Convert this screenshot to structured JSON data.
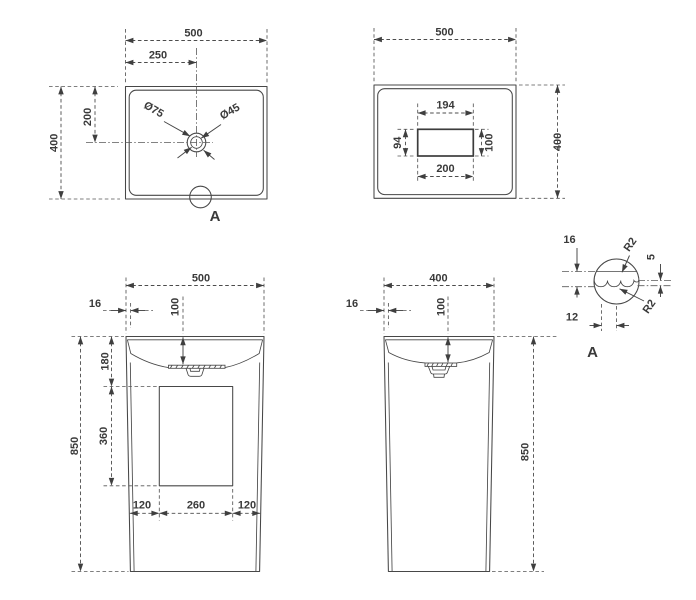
{
  "views": {
    "plan_top": {
      "overall_width": "500",
      "hole_offset_x": "250",
      "overall_depth": "400",
      "hole_offset_y": "200",
      "faucet_hole_dia": "Ø75",
      "drain_hole_dia": "Ø45",
      "detail_marker": "A"
    },
    "plan_bottom": {
      "overall_width": "500",
      "overall_depth": "400",
      "slot_top": "194",
      "slot_left": "94",
      "slot_right": "100",
      "slot_bottom": "200"
    },
    "front": {
      "overall_width": "500",
      "rim_offset": "16",
      "basin_depth": "100",
      "apron_height": "180",
      "opening_height": "360",
      "overall_height": "850",
      "base_left": "120",
      "base_center": "260",
      "base_right": "120"
    },
    "side": {
      "overall_depth": "400",
      "rim_offset": "16",
      "basin_depth": "100",
      "overall_height": "850"
    },
    "detail_a": {
      "rim_thickness": "16",
      "top_radius": "R2",
      "wave_height": "5",
      "bottom_radius": "R2",
      "wave_width": "12",
      "label": "A"
    }
  }
}
